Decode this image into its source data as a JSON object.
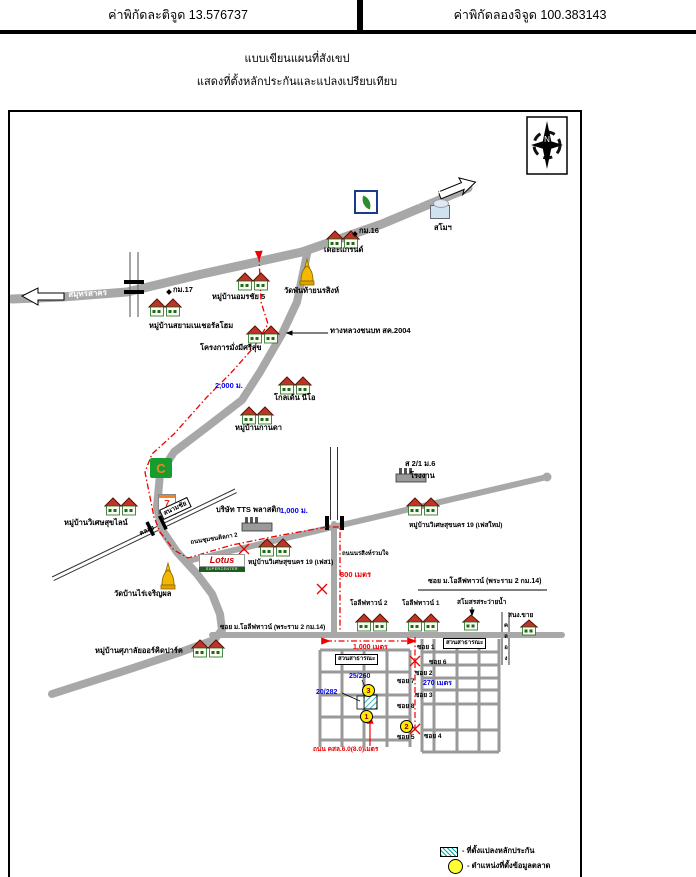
{
  "header": {
    "lat": "ค่าพิกัดละติจูด 13.576737",
    "lon": "ค่าพิกัดลองจิจูด 100.383143"
  },
  "title": {
    "line1": "แบบเขียนแผนที่สังเขป",
    "line2": "แสดงที่ตั้งหลักประกันและแปลงเปรียบเทียบ"
  },
  "compass": {
    "n": "N"
  },
  "roads": {
    "rama2": "ถนนพระราม 2(ทล.35)",
    "bangkok": "กรุงเทพ ฯ",
    "samutsakhon": "สมุทรสาคร",
    "rural_highway": "ทางหลวงชนบท สค.2004",
    "km16": "กม.16",
    "km17": "กม.17",
    "chumchon": "ถนนชุมชนติลกา 2",
    "norasing": "ถนนนรสิงห์รวมใจ",
    "olive_soi": "ซอย ม.โอลีฟทาวน์ (พระราม 2 กม.14)",
    "khlong": "คลอง",
    "sanamchai": "สนามชัย",
    "khlong_side": "คลอง",
    "concrete": "ถนน คสล.6.0(8.0)เมตร"
  },
  "places": {
    "the_grand": "เดอะแกรนด์",
    "samo": "สโมฯ",
    "amornchai": "หมู่บ้านอมรชัย 5",
    "wat_phanthai": "วัดพันท้ายนรสิงห์",
    "siam_natural": "หมู่บ้านสยามเนเชอรัลโฮม",
    "mangmee": "โครงการมั่งมีศรีสุข",
    "golden_neo": "โกลเด้น นีโอ",
    "kanda": "หมู่บ้านกานดา",
    "wiset_line": "หมู่บ้านวิเศษสุขไลน์",
    "tts": "บริษัท TTS พลาสติก",
    "wiset19_p1": "หมู่บ้านวิเศษสุขนคร 19 (เฟส1)",
    "wiset19_new": "หมู่บ้านวิเศษสุขนคร 19 (เฟสใหม่)",
    "address": "ส 2/1 ม.6",
    "factory": "โรงงาน",
    "wat_banrai": "วัดบ้านไร่เจริญผล",
    "supalai": "หมู่บ้านศุภาลัยออร์คิดปาร์ค",
    "olive1": "โอลีฟทาวน์ 1",
    "olive2": "โอลีฟทาวน์ 2",
    "club_pool": "สโมสรสระว่ายน้ำ",
    "sales_office": "สนง.ขาย",
    "park": "สวนสาธารณะ"
  },
  "sois": {
    "s1": "ซอย 1",
    "s2": "ซอย 2",
    "s3": "ซอย 3",
    "s4": "ซอย 4",
    "s5": "ซอย 5",
    "s6": "ซอย 6",
    "s7": "ซอย 7",
    "s8": "ซอย 8"
  },
  "distances": {
    "d2000": "2,000 ม.",
    "d1000m": "1,000 ม.",
    "d800": "800 เมตร",
    "d1000": "1,000 เมตร",
    "d270": "270 เมตร"
  },
  "plots": {
    "p25260": "25/260",
    "p20282": "20/282"
  },
  "markers": {
    "m1": "1",
    "m2": "2",
    "m3": "3"
  },
  "legend": {
    "item1": "- ที่ตั้งแปลงหลักประกัน",
    "item2": "- ตำแหน่งที่ตั้งข้อมูลตลาด"
  },
  "logos": {
    "lotus": "Lotus",
    "lotus_sub": "SUPERCENTER",
    "seven": "7",
    "cj": "C"
  },
  "colors": {
    "route_red": "#EE0000",
    "distance_blue": "#0000EE",
    "road_gray": "#A8A8A8",
    "hatch_teal": "#00AAAA",
    "marker_yellow": "#FFEB00"
  }
}
